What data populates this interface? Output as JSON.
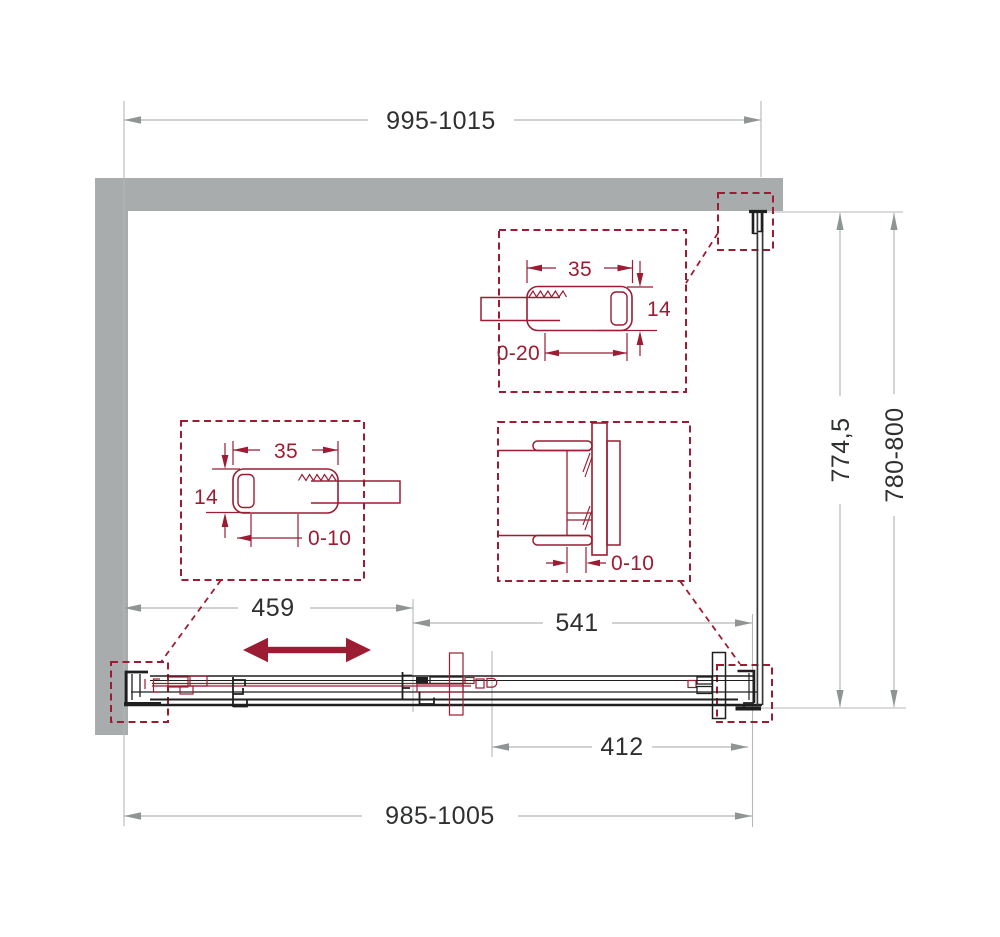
{
  "drawing": {
    "type": "shower-enclosure-plan-technical-drawing",
    "colors": {
      "wall": "#a9acac",
      "accent": "#9b1c33",
      "profile_line": "#1f1f1f",
      "dimension_line": "#b3b7b7",
      "dimension_text": "#2d2f30"
    },
    "dims": {
      "top_width": "995-1015",
      "bottom_width": "985-1005",
      "door_panel": "459",
      "fixed_section": "541",
      "opening": "412",
      "depth_inner": "774,5",
      "depth_range": "780-800"
    },
    "details": {
      "top_profile": {
        "width": "35",
        "height": "14",
        "adjust": "0-20"
      },
      "left_profile": {
        "width": "35",
        "height": "14",
        "adjust": "0-10"
      },
      "right_profile": {
        "adjust": "0-10"
      }
    }
  }
}
